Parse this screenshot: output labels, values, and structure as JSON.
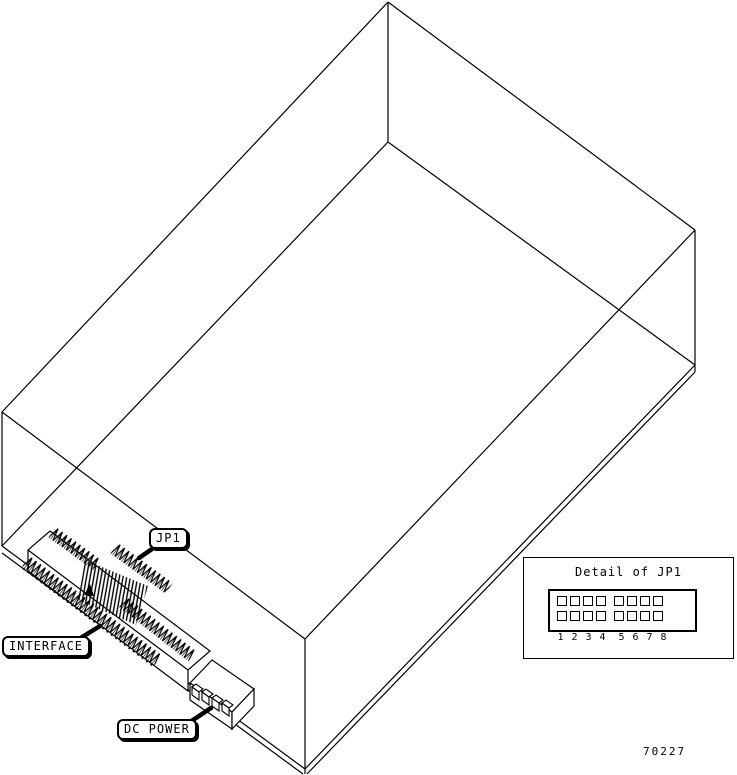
{
  "figure": {
    "callouts": {
      "jp1": "JP1",
      "interface": "INTERFACE",
      "dc_power": "DC POWER"
    },
    "inset": {
      "title": "Detail of JP1",
      "pin_rows": 2,
      "pin_columns": 8,
      "pin_numbers": [
        "1",
        "2",
        "3",
        "4",
        "5",
        "6",
        "7",
        "8"
      ]
    },
    "figure_number": "70227",
    "colors": {
      "line": "#000000",
      "background": "#ffffff"
    }
  }
}
